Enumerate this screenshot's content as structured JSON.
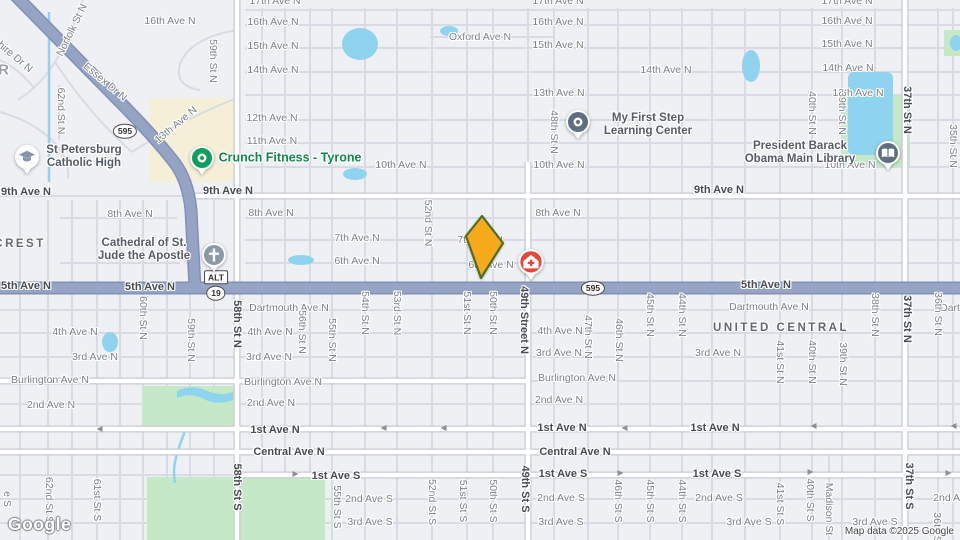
{
  "colors": {
    "land": "#eef0f3",
    "water": "#8ed4ee",
    "park": "#c5e8c6",
    "commercial": "#f6efd8",
    "road_major": "#95a4c4",
    "road_major_casing": "#8291b1",
    "road_minor": "#d8dbe3",
    "marker_fill": "#f7a91c",
    "marker_stroke": "#4e6e1f",
    "pin_green": "#0ca05e",
    "pin_gray": "#8a98a8",
    "pin_slate": "#5f6e80",
    "pin_red": "#e8453b",
    "pin_school_glyph": "#8594ac",
    "label_green": "#12874c"
  },
  "branding": {
    "logo": "Google",
    "attribution": "Map data ©2025 Google"
  },
  "labels": [
    {
      "t": "17th Ave N",
      "x": 275,
      "y": 1
    },
    {
      "t": "17th Ave N",
      "x": 558,
      "y": 1
    },
    {
      "t": "17th Ave N",
      "x": 847,
      "y": 1
    },
    {
      "t": "16th Ave N",
      "x": 170,
      "y": 21
    },
    {
      "t": "16th Ave N",
      "x": 273,
      "y": 22
    },
    {
      "t": "16th Ave N",
      "x": 558,
      "y": 22
    },
    {
      "t": "16th Ave N",
      "x": 847,
      "y": 21
    },
    {
      "t": "15th Ave N",
      "x": 273,
      "y": 46
    },
    {
      "t": "15th Ave N",
      "x": 558,
      "y": 45
    },
    {
      "t": "15th Ave N",
      "x": 847,
      "y": 44
    },
    {
      "t": "Oxford Ave N",
      "x": 480,
      "y": 37
    },
    {
      "t": "14th Ave N",
      "x": 273,
      "y": 70
    },
    {
      "t": "14th Ave N",
      "x": 666,
      "y": 70
    },
    {
      "t": "14th Ave N",
      "x": 848,
      "y": 68
    },
    {
      "t": "13th Ave N",
      "x": 559,
      "y": 93
    },
    {
      "t": "13th Ave N",
      "x": 858,
      "y": 93
    },
    {
      "t": "12th Ave N",
      "x": 272,
      "y": 118
    },
    {
      "t": "11th Ave N",
      "x": 272,
      "y": 141
    },
    {
      "t": "10th Ave N",
      "x": 401,
      "y": 165
    },
    {
      "t": "10th Ave N",
      "x": 559,
      "y": 165
    },
    {
      "t": "10th Ave N",
      "x": 850,
      "y": 165
    },
    {
      "t": "8th Ave N",
      "x": 130,
      "y": 214
    },
    {
      "t": "8th Ave N",
      "x": 271,
      "y": 213
    },
    {
      "t": "8th Ave N",
      "x": 558,
      "y": 213
    },
    {
      "t": "7th Ave N",
      "x": 357,
      "y": 238
    },
    {
      "t": "7th Ave N",
      "x": 480,
      "y": 240
    },
    {
      "t": "6th Ave N",
      "x": 357,
      "y": 261
    },
    {
      "t": "6th Ave N",
      "x": 491,
      "y": 265
    },
    {
      "t": "Dartmouth Ave N",
      "x": 289,
      "y": 308
    },
    {
      "t": "Dartmouth Ave N",
      "x": 769,
      "y": 307
    },
    {
      "t": "Dartmouth Ave N",
      "x": 980,
      "y": 308
    },
    {
      "t": "4th Ave N",
      "x": 75,
      "y": 332
    },
    {
      "t": "4th Ave N",
      "x": 270,
      "y": 332
    },
    {
      "t": "4th Ave N",
      "x": 560,
      "y": 331
    },
    {
      "t": "3rd Ave N",
      "x": 95,
      "y": 357
    },
    {
      "t": "3rd Ave N",
      "x": 269,
      "y": 357
    },
    {
      "t": "3rd Ave N",
      "x": 559,
      "y": 353
    },
    {
      "t": "3rd Ave N",
      "x": 718,
      "y": 353
    },
    {
      "t": "Burlington Ave N",
      "x": 50,
      "y": 380
    },
    {
      "t": "Burlington Ave N",
      "x": 283,
      "y": 382
    },
    {
      "t": "Burlington Ave N",
      "x": 577,
      "y": 378
    },
    {
      "t": "2nd Ave N",
      "x": 51,
      "y": 405
    },
    {
      "t": "2nd Ave N",
      "x": 271,
      "y": 403
    },
    {
      "t": "2nd Ave N",
      "x": 559,
      "y": 400
    },
    {
      "t": "2nd Ave S",
      "x": 369,
      "y": 499
    },
    {
      "t": "2nd Ave S",
      "x": 561,
      "y": 498
    },
    {
      "t": "2nd Ave S",
      "x": 719,
      "y": 498
    },
    {
      "t": "2nd Ave S",
      "x": 957,
      "y": 498
    },
    {
      "t": "3rd Ave S",
      "x": 370,
      "y": 522
    },
    {
      "t": "3rd Ave S",
      "x": 561,
      "y": 522
    },
    {
      "t": "3rd Ave S",
      "x": 749,
      "y": 522
    },
    {
      "t": "3rd Ave S",
      "x": 875,
      "y": 522
    },
    {
      "t": "9th Ave N",
      "x": 26,
      "y": 192,
      "k": "b"
    },
    {
      "t": "9th Ave N",
      "x": 228,
      "y": 191,
      "k": "b"
    },
    {
      "t": "9th Ave N",
      "x": 719,
      "y": 190,
      "k": "b"
    },
    {
      "t": "5th Ave N",
      "x": 26,
      "y": 286,
      "k": "b"
    },
    {
      "t": "5th Ave N",
      "x": 150,
      "y": 287,
      "k": "b"
    },
    {
      "t": "5th Ave N",
      "x": 766,
      "y": 285,
      "k": "b"
    },
    {
      "t": "1st Ave N",
      "x": 275,
      "y": 430,
      "k": "b"
    },
    {
      "t": "1st Ave N",
      "x": 562,
      "y": 428,
      "k": "b"
    },
    {
      "t": "1st Ave N",
      "x": 715,
      "y": 428,
      "k": "b"
    },
    {
      "t": "Central Ave N",
      "x": 289,
      "y": 452,
      "k": "b"
    },
    {
      "t": "Central Ave N",
      "x": 575,
      "y": 452,
      "k": "b"
    },
    {
      "t": "1st Ave S",
      "x": 336,
      "y": 476,
      "k": "b"
    },
    {
      "t": "1st Ave S",
      "x": 563,
      "y": 474,
      "k": "b"
    },
    {
      "t": "1st Ave S",
      "x": 717,
      "y": 474,
      "k": "b"
    },
    {
      "t": "59th St N",
      "x": 213,
      "y": 61,
      "r": 90
    },
    {
      "t": "48th St N",
      "x": 554,
      "y": 132,
      "r": 90
    },
    {
      "t": "40th St N",
      "x": 812,
      "y": 113,
      "r": 90
    },
    {
      "t": "39th St N",
      "x": 842,
      "y": 113,
      "r": 90
    },
    {
      "t": "35th St N",
      "x": 953,
      "y": 146,
      "r": 90
    },
    {
      "t": "52nd St N",
      "x": 428,
      "y": 223,
      "r": 90
    },
    {
      "t": "62nd St N",
      "x": 61,
      "y": 111,
      "r": 90
    },
    {
      "t": "60th St N",
      "x": 143,
      "y": 318,
      "r": 90
    },
    {
      "t": "59th St N",
      "x": 191,
      "y": 340,
      "r": 90
    },
    {
      "t": "56th St N",
      "x": 302,
      "y": 332,
      "r": 90
    },
    {
      "t": "55th St N",
      "x": 332,
      "y": 340,
      "r": 90
    },
    {
      "t": "54th St N",
      "x": 365,
      "y": 313,
      "r": 90
    },
    {
      "t": "53rd St N",
      "x": 397,
      "y": 313,
      "r": 90
    },
    {
      "t": "51st St N",
      "x": 467,
      "y": 313,
      "r": 90
    },
    {
      "t": "50th St N",
      "x": 493,
      "y": 313,
      "r": 90
    },
    {
      "t": "47th St N",
      "x": 588,
      "y": 337,
      "r": 90
    },
    {
      "t": "46th St N",
      "x": 619,
      "y": 340,
      "r": 90
    },
    {
      "t": "45th St N",
      "x": 650,
      "y": 315,
      "r": 90
    },
    {
      "t": "44th St N",
      "x": 682,
      "y": 315,
      "r": 90
    },
    {
      "t": "41st St N",
      "x": 780,
      "y": 362,
      "r": 90
    },
    {
      "t": "40th St N",
      "x": 812,
      "y": 362,
      "r": 90
    },
    {
      "t": "39th St N",
      "x": 843,
      "y": 364,
      "r": 90
    },
    {
      "t": "38th St N",
      "x": 875,
      "y": 315,
      "r": 90
    },
    {
      "t": "36th St N",
      "x": 938,
      "y": 314,
      "r": 90
    },
    {
      "t": "62nd St S",
      "x": 49,
      "y": 500,
      "r": 90
    },
    {
      "t": "61st St S",
      "x": 97,
      "y": 500,
      "r": 90
    },
    {
      "t": "e S",
      "x": 7,
      "y": 499,
      "r": 90
    },
    {
      "t": "55th St S",
      "x": 337,
      "y": 507,
      "r": 90
    },
    {
      "t": "52nd St S",
      "x": 432,
      "y": 502,
      "r": 90
    },
    {
      "t": "51st St S",
      "x": 463,
      "y": 501,
      "r": 90
    },
    {
      "t": "50th St S",
      "x": 493,
      "y": 501,
      "r": 90
    },
    {
      "t": "46th St S",
      "x": 618,
      "y": 501,
      "r": 90
    },
    {
      "t": "45th St S",
      "x": 650,
      "y": 501,
      "r": 90
    },
    {
      "t": "44th St S",
      "x": 682,
      "y": 501,
      "r": 90
    },
    {
      "t": "41st St S",
      "x": 780,
      "y": 504,
      "r": 90
    },
    {
      "t": "40th St S",
      "x": 810,
      "y": 500,
      "r": 90
    },
    {
      "t": "Madison St",
      "x": 829,
      "y": 509,
      "r": 90
    },
    {
      "t": "36th St S",
      "x": 937,
      "y": 534,
      "r": 90
    },
    {
      "t": "58th St N",
      "x": 237,
      "y": 324,
      "k": "b",
      "r": 90
    },
    {
      "t": "49th Street N",
      "x": 524,
      "y": 320,
      "k": "b",
      "r": 90
    },
    {
      "t": "37th St N",
      "x": 907,
      "y": 110,
      "k": "b",
      "r": 90
    },
    {
      "t": "37th St N",
      "x": 907,
      "y": 319,
      "k": "b",
      "r": 90
    },
    {
      "t": "58th St S",
      "x": 237,
      "y": 487,
      "k": "b",
      "r": 90
    },
    {
      "t": "49th St S",
      "x": 525,
      "y": 489,
      "k": "b",
      "r": 90
    },
    {
      "t": "37th St S",
      "x": 909,
      "y": 486,
      "k": "b",
      "r": 90
    },
    {
      "t": "Norfolk St N",
      "x": 72,
      "y": 30,
      "r": -64
    },
    {
      "t": "hire Dr N",
      "x": 15,
      "y": 57,
      "r": 40
    },
    {
      "t": "Essex Dr N",
      "x": 105,
      "y": 82,
      "r": 40
    },
    {
      "t": "13th Ave N",
      "x": 176,
      "y": 125,
      "r": -40
    },
    {
      "t": "CREST",
      "x": 20,
      "y": 244,
      "k": "n",
      "n": "neighborhood-label"
    },
    {
      "t": "UNITED CENTRAL",
      "x": 781,
      "y": 328,
      "k": "n",
      "n": "neighborhood-label"
    },
    {
      "t": "R",
      "x": 4,
      "y": 70,
      "k": "g",
      "n": "neighborhood-label"
    }
  ],
  "shields": [
    {
      "type": "oval",
      "text": "595",
      "x": 125,
      "y": 131
    },
    {
      "type": "oval",
      "text": "595",
      "x": 593,
      "y": 288
    },
    {
      "type": "rect",
      "text": "ALT",
      "x": 216,
      "y": 277
    },
    {
      "type": "oval",
      "text": "19",
      "x": 216,
      "y": 293
    }
  ],
  "arrows": [
    {
      "d": "l",
      "x": 98,
      "y": 429
    },
    {
      "d": "l",
      "x": 382,
      "y": 428
    },
    {
      "d": "l",
      "x": 442,
      "y": 428
    },
    {
      "d": "l",
      "x": 623,
      "y": 428
    },
    {
      "d": "l",
      "x": 812,
      "y": 426
    },
    {
      "d": "l",
      "x": 952,
      "y": 426
    },
    {
      "d": "r",
      "x": 297,
      "y": 474
    },
    {
      "d": "r",
      "x": 622,
      "y": 473
    },
    {
      "d": "r",
      "x": 812,
      "y": 472
    },
    {
      "d": "r",
      "x": 950,
      "y": 473
    }
  ],
  "pois": [
    {
      "id": "st-petersburg-catholic-high",
      "icon": "graduation-cap",
      "color": "pin_gray",
      "pin": [
        27,
        157
      ],
      "label": {
        "lines": [
          "St Petersburg",
          "Catholic High"
        ],
        "x": 84,
        "y": 157,
        "cls": "civic"
      }
    },
    {
      "id": "crunch-fitness-tyrone",
      "icon": "dot",
      "color": "pin_green",
      "pin": [
        202,
        158
      ],
      "label": {
        "lines": [
          "Crunch Fitness - Tyrone"
        ],
        "x": 290,
        "y": 158,
        "cls": "green lg"
      }
    },
    {
      "id": "my-first-step-learning-center",
      "icon": "dot",
      "color": "pin_slate",
      "pin": [
        578,
        122
      ],
      "label": {
        "lines": [
          "My First Step",
          "Learning Center"
        ],
        "x": 648,
        "y": 125,
        "cls": "civic"
      }
    },
    {
      "id": "cathedral-of-st-jude-the-apostle",
      "icon": "cross",
      "color": "pin_gray",
      "pin": [
        214,
        255
      ],
      "label": {
        "lines": [
          "Cathedral of St.",
          "Jude the Apostle"
        ],
        "x": 144,
        "y": 250,
        "cls": "civic"
      }
    },
    {
      "id": "president-barack-obama-main-library",
      "icon": "book",
      "color": "pin_slate",
      "pin": [
        888,
        153
      ],
      "label": {
        "lines": [
          "President Barack",
          "Obama Main Library"
        ],
        "x": 800,
        "y": 153,
        "cls": "civic"
      }
    },
    {
      "id": "medical-clinic-marker",
      "icon": "medical",
      "color": "pin_red",
      "pin": [
        531,
        262
      ],
      "label": null
    }
  ]
}
